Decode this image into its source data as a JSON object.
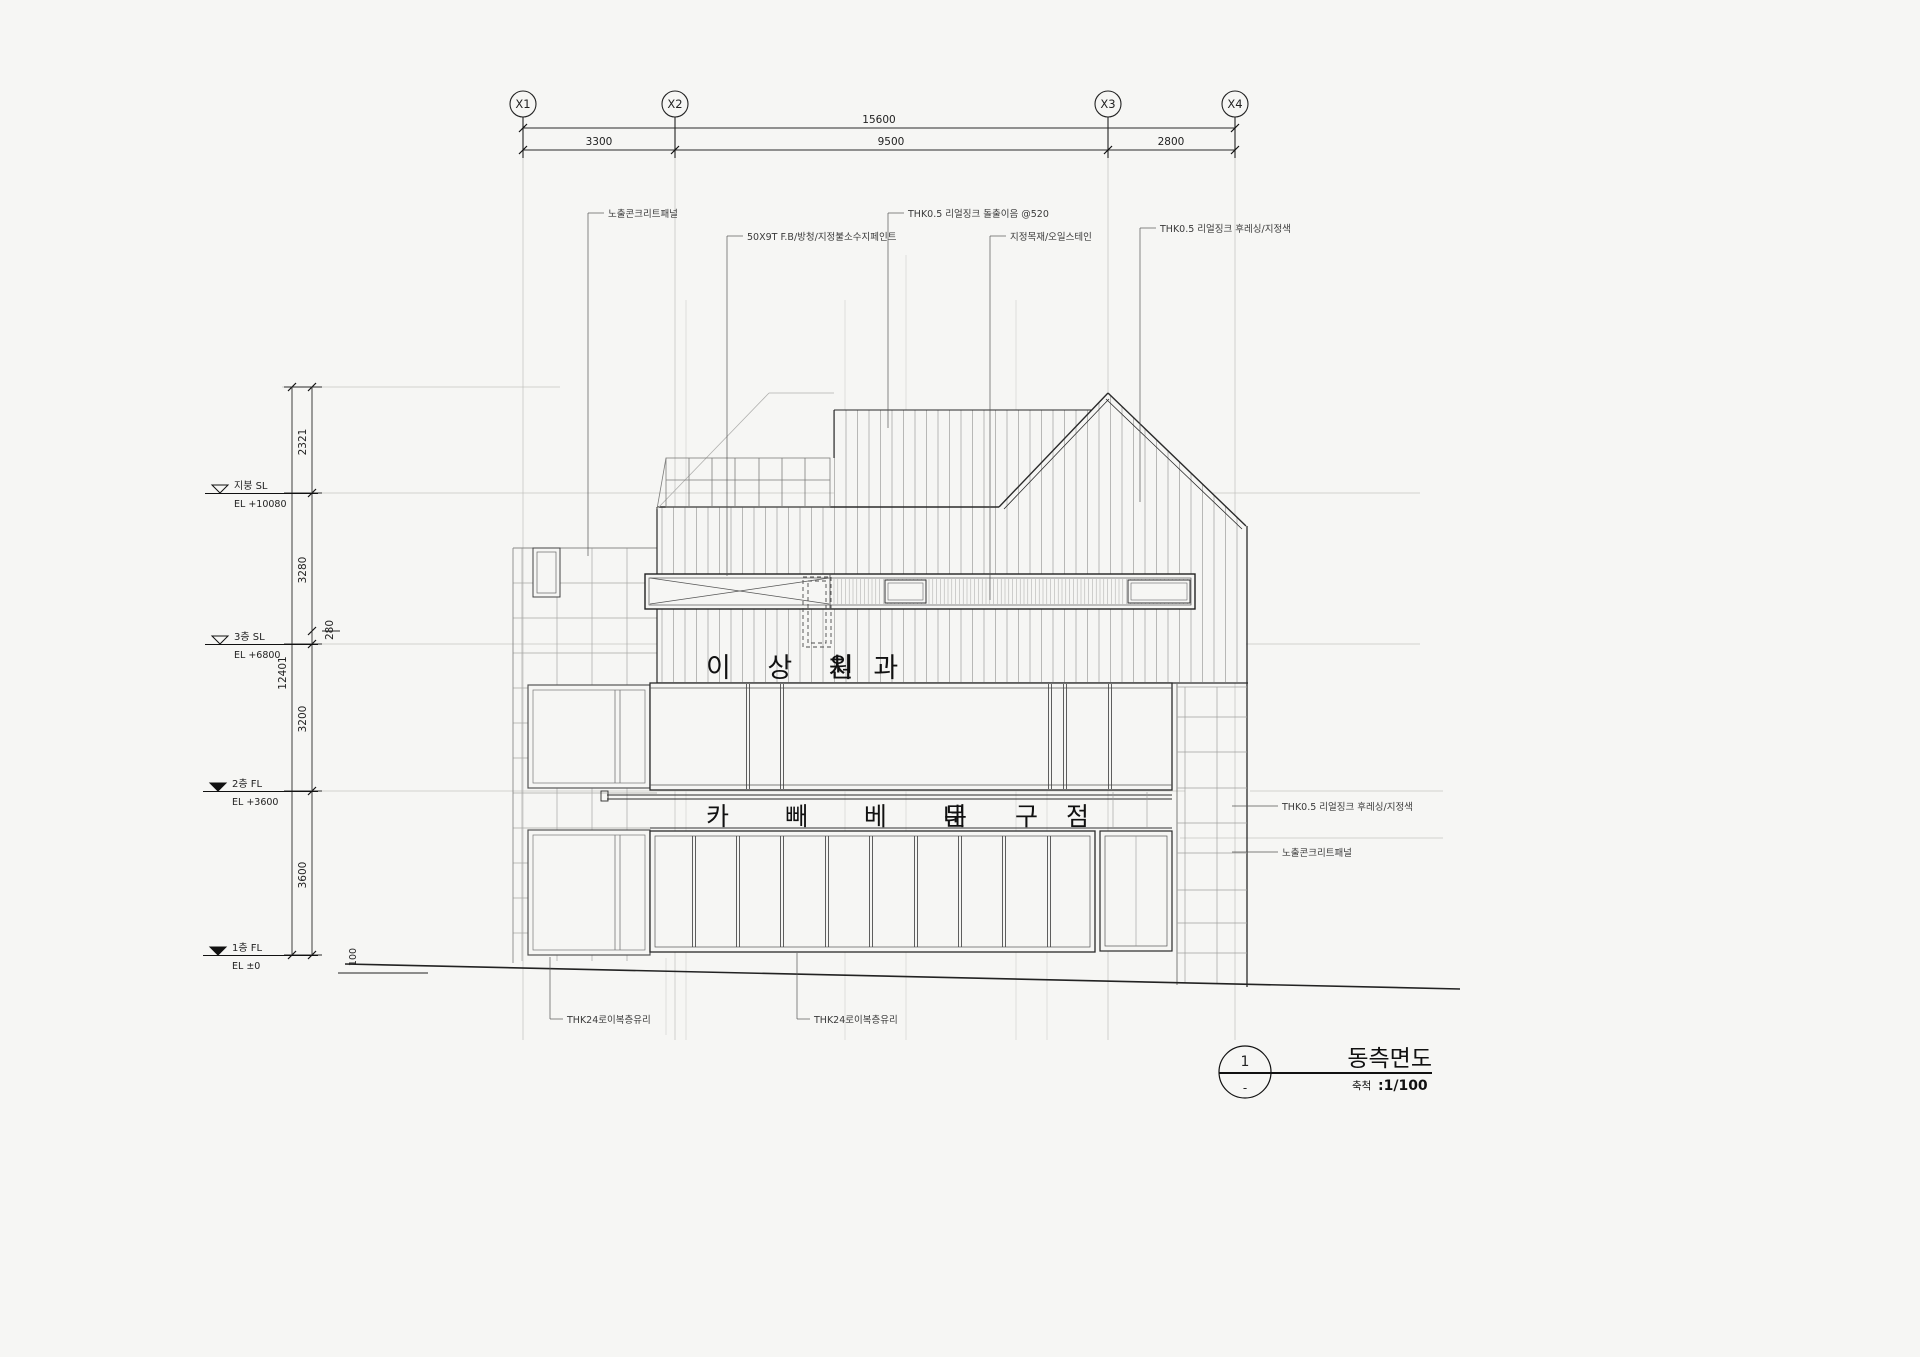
{
  "drawing": {
    "type": "architectural-elevation",
    "colors": {
      "background": "#f6f6f4",
      "line_main": "#2a2a2a",
      "line_light": "#9a9a9a"
    },
    "grid": {
      "labels": [
        "X1",
        "X2",
        "X3",
        "X4"
      ]
    },
    "dims": {
      "overall": "15600",
      "x_spans": [
        "3300",
        "9500",
        "2800"
      ],
      "y_chain": [
        "2321",
        "3280",
        "3200",
        "3600"
      ],
      "y_total": "12401",
      "offset_small": "280",
      "offset_ground": "100"
    },
    "levels": [
      {
        "name": "지붕 SL",
        "el": "EL +10080"
      },
      {
        "name": "3층 SL",
        "el": "EL +6800"
      },
      {
        "name": "2층 FL",
        "el": "EL +3600"
      },
      {
        "name": "1층 FL",
        "el": "EL ±0"
      }
    ],
    "annotations": {
      "top": [
        "노출콘크리트패널",
        "50X9T F.B/방청/지정불소수지페인트",
        "THK0.5 리얼징크 돌출이음 @520",
        "지정목재/오일스테인",
        "THK0.5 리얼징크 후레싱/지정색"
      ],
      "right": [
        "THK0.5 리얼징크 후레싱/지정색",
        "노출콘크리트패널"
      ],
      "bottom": [
        "THK24로이복층유리",
        "THK24로이복층유리"
      ]
    },
    "signs": {
      "line1_left": "이 상 원",
      "line1_right": "치 과",
      "line2_left": "카 빼 베 네",
      "line2_mid": "문 구",
      "line2_right": "점"
    },
    "titleblock": {
      "number": "1",
      "sub": "-",
      "title": "동측면도",
      "scale_prefix": "축척",
      "scale_value": ":1/100"
    }
  }
}
